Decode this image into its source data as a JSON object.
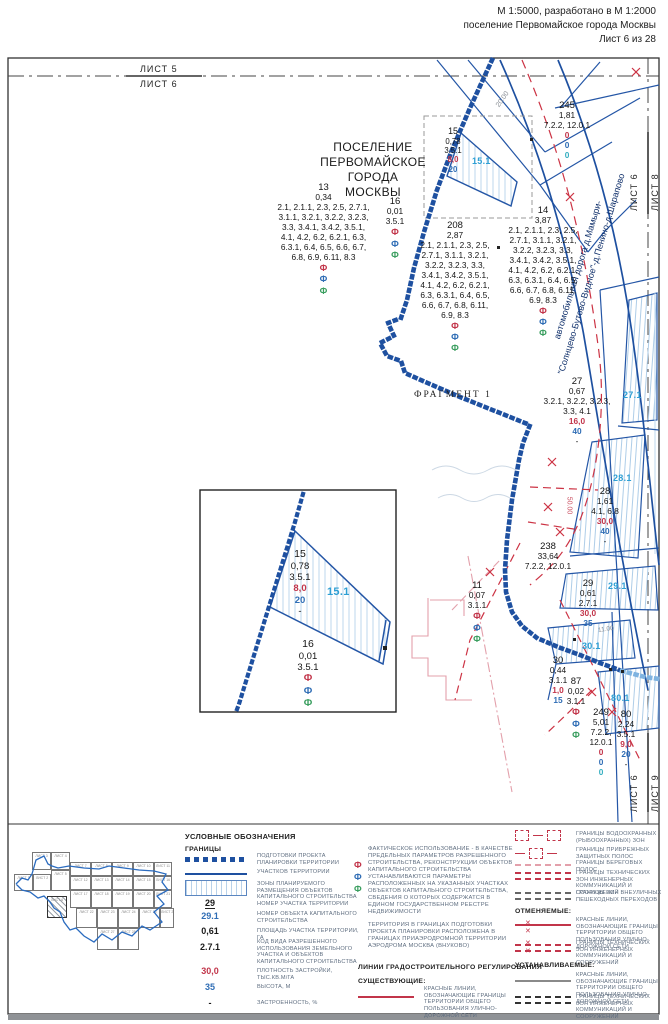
{
  "header": {
    "line1": "М 1:5000, разработано в М 1:2000",
    "line2": "поселение Первомайское города Москвы",
    "line3": "Лист 6 из 28"
  },
  "edge_labels": {
    "top_a": "ЛИСТ 5",
    "top_b": "ЛИСТ 6",
    "right_top_a": "ЛИСТ 6",
    "right_top_b": "ЛИСТ 8",
    "right_bottom_a": "ЛИСТ 6",
    "right_bottom_b": "ЛИСТ 9"
  },
  "map": {
    "settlement_line1": "ПОСЕЛЕНИЕ",
    "settlement_line2": "ПЕРВОМАЙСКОЕ",
    "settlement_line3": "ГОРОДА МОСКВЫ",
    "fragment_label": "ФРАГМЕНТ 1",
    "road_line1": "автомобильная дорога д.Мамыри-",
    "road_line2": "\"Солнцево-Бутово-Видное\"-д.Пенино-д.Шарапово",
    "dims": {
      "d20": "20.00",
      "d50": "50.00",
      "d11": "11.00"
    },
    "glyph_fact": "Ф",
    "parcels": {
      "p13": {
        "num": "13",
        "area": "0,34",
        "codes": "2.1, 2.1.1, 2.3, 2.5, 2.7.1, 3.1.1, 3.2.1, 3.2.2, 3.2.3, 3.3, 3.4.1, 3.4.2, 3.5.1, 4.1, 4.2, 6.2, 6.2.1, 6.3, 6.3.1, 6.4, 6.5, 6.6, 6.7, 6.8, 6.9, 6.11, 8.3"
      },
      "p16": {
        "num": "16",
        "area": "0,01",
        "codes": "3.5.1"
      },
      "p15": {
        "num": "15",
        "area": "0,78",
        "codes": "3.5.1",
        "density": "8,0",
        "height": "20",
        "built": "-"
      },
      "p245": {
        "num": "245",
        "area": "1,81",
        "codes": "7.2.2, 12.0.1",
        "density": "0",
        "height": "0",
        "built": "0"
      },
      "p208": {
        "num": "208",
        "area": "2,87",
        "codes": "2.1, 2.1.1, 2.3, 2.5, 2.7.1, 3.1.1, 3.2.1, 3.2.2, 3.2.3, 3.3, 3.4.1, 3.4.2, 3.5.1, 4.1, 4.2, 6.2, 6.2.1, 6.3, 6.3.1, 6.4, 6.5, 6.6, 6.7, 6.8, 6.11, 6.9, 8.3"
      },
      "p14": {
        "num": "14",
        "area": "3,87",
        "codes": "2.1, 2.1.1, 2.3, 2.5, 2.7.1, 3.1.1, 3.2.1, 3.2.2, 3.2.3, 3.3, 3.4.1, 3.4.2, 3.5.1, 4.1, 4.2, 6.2, 6.2.1, 6.3, 6.3.1, 6.4, 6.5, 6.6, 6.7, 6.8, 6.11, 6.9, 8.3"
      },
      "p27": {
        "num": "27",
        "area": "0,67",
        "codes": "3.2.1, 3.2.2, 3.2.3, 3.3, 4.1",
        "density": "16,0",
        "height": "40",
        "built": "-"
      },
      "p28": {
        "num": "28",
        "area": "1,61",
        "codes": "4.1, 6.8",
        "density": "30,0",
        "height": "40",
        "built": "-"
      },
      "p238": {
        "num": "238",
        "area": "33,64",
        "codes": "7.2.2, 12.0.1"
      },
      "p11": {
        "num": "11",
        "area": "0,07",
        "codes": "3.1.1"
      },
      "p29": {
        "num": "29",
        "area": "0,61",
        "codes": "2.7.1",
        "density": "30,0",
        "height": "35",
        "built": "-"
      },
      "p30": {
        "num": "30",
        "area": "0,44",
        "codes": "3.1.1",
        "density": "1,0",
        "height": "15",
        "built": "-"
      },
      "p87": {
        "num": "87",
        "area": "0,02",
        "codes": "3.1.1"
      },
      "p249": {
        "num": "249",
        "area": "5,01",
        "codes": "7.2.2, 12.0.1",
        "density": "0",
        "height": "0",
        "built": "0"
      },
      "p80": {
        "num": "80",
        "area": "2,24",
        "codes": "3.5.1",
        "density": "9,0",
        "height": "20",
        "built": "-"
      }
    },
    "zones": {
      "z15": "15.1",
      "z27": "27.1",
      "z28": "28.1",
      "z29": "29.1",
      "z30": "30.1",
      "z80": "80.1"
    }
  },
  "legend": {
    "title": "УСЛОВНЫЕ ОБОЗНАЧЕНИЯ",
    "granitsy": "ГРАНИЦЫ",
    "b_dotted": "ПОДГОТОВКИ ПРОЕКТА ПЛАНИРОВКИ ТЕРРИТОРИИ",
    "b_solid": "УЧАСТКОВ ТЕРРИТОРИИ",
    "b_hatch": "ЗОНЫ ПЛАНИРУЕМОГО РАЗМЕЩЕНИЯ ОБЪЕКТОВ КАПИТАЛЬНОГО СТРОИТЕЛЬСТВА",
    "n29": "29",
    "n29_l": "НОМЕР УЧАСТКА ТЕРРИТОРИИ",
    "n291": "29.1",
    "n291_l": "НОМЕР ОБЪЕКТА КАПИТАЛЬНОГО СТРОИТЕЛЬСТВА",
    "a061": "0,61",
    "a061_l": "ПЛОЩАДЬ УЧАСТКА ТЕРРИТОРИИ, ГА",
    "c271": "2.7.1",
    "c271_l": "КОД ВИДА РАЗРЕШЕННОГО ИСПОЛЬЗОВАНИЯ ЗЕМЕЛЬНОГО УЧАСТКА И ОБЪЕКТОВ КАПИТАЛЬНОГО СТРОИТЕЛЬСТВА",
    "d300": "30,0",
    "d300_l": "ПЛОТНОСТЬ ЗАСТРОЙКИ, ТЫС.КВ.М/ГА",
    "h35": "35",
    "h35_l": "ВЫСОТА, М",
    "dash": "-",
    "dash_l": "ЗАСТРОЕННОСТЬ, %",
    "fact_text": "ФАКТИЧЕСКОЕ ИСПОЛЬЗОВАНИЕ - В КАЧЕСТВЕ ПРЕДЕЛЬНЫХ ПАРАМЕТРОВ РАЗРЕШЕННОГО СТРОИТЕЛЬСТВА, РЕКОНСТРУКЦИИ ОБЪЕКТОВ КАПИТАЛЬНОГО СТРОИТЕЛЬСТВА УСТАНАВЛИВАЮТСЯ ПАРАМЕТРЫ РАСПОЛОЖЕННЫХ НА УКАЗАННЫХ УЧАСТКАХ ОБЪЕКТОВ КАПИТАЛЬНОГО СТРОИТЕЛЬСТВА, СВЕДЕНИЯ О КОТОРЫХ СОДЕРЖАТСЯ В ЕДИНОМ ГОСУДАРСТВЕННОМ РЕЕСТРЕ НЕДВИЖИМОСТИ",
    "terr_text": "ТЕРРИТОРИЯ В ГРАНИЦАХ ПОДГОТОВКИ ПРОЕКТА ПЛАНИРОВКИ РАСПОЛОЖЕНА В ГРАНИЦАХ ПРИАЭРОДРОМНОЙ ТЕРРИТОРИИ АЭРОДРОМА МОСКВА (ВНУКОВО)",
    "lines_head": "ЛИНИИ ГРАДОСТРОИТЕЛЬНОГО РЕГУЛИРОВАНИЯ",
    "exist_head": "СУЩЕСТВУЮЩИЕ:",
    "red_lines_l": "КРАСНЫЕ ЛИНИИ, ОБОЗНАЧАЮЩИЕ ГРАНИЦЫ ТЕРРИТОРИИ ОБЩЕГО ПОЛЬЗОВАНИЯ УЛИЧНО-ДОРОЖНОЙ СЕТИ",
    "water_l": "ГРАНИЦЫ ВОДООХРАННЫХ (РЫБООХРАННЫХ) ЗОН",
    "coastp_l": "ГРАНИЦЫ ПРИБРЕЖНЫХ ЗАЩИТНЫХ ПОЛОС",
    "coast_l": "ГРАНИЦЫ БЕРЕГОВЫХ ПОЛОС",
    "tech_l": "ГРАНИЦЫ ТЕХНИЧЕСКИХ ЗОН ИНЖЕНЕРНЫХ КОММУНИКАЦИЙ И СООРУЖЕНИЙ",
    "ped_l": "ГРАНИЦЫ ЗОН ВНЕУЛИЧНЫХ ПЕШЕХОДНЫХ ПЕРЕХОДОВ",
    "cancel_head": "ОТМЕНЯЕМЫЕ:",
    "set_head": "УСТАНАВЛИВАЕМЫЕ:",
    "minimap": {
      "sheets": [
        {
          "l": "ЛИСТ 3",
          "x": 18,
          "y": 8,
          "w": 19,
          "h": 18
        },
        {
          "l": "ЛИСТ 4",
          "x": 37,
          "y": 8,
          "w": 19,
          "h": 18
        },
        {
          "l": "ЛИСТ 1",
          "x": 0,
          "y": 30,
          "w": 19,
          "h": 17
        },
        {
          "l": "ЛИСТ 2",
          "x": 19,
          "y": 30,
          "w": 18,
          "h": 17
        },
        {
          "l": "ЛИСТ 5",
          "x": 37,
          "y": 26,
          "w": 19,
          "h": 21
        },
        {
          "l": "ЛИСТ 6",
          "x": 33,
          "y": 52,
          "w": 20,
          "h": 22,
          "hatch": true
        },
        {
          "l": "ЛИСТ 7",
          "x": 56,
          "y": 18,
          "w": 21,
          "h": 14
        },
        {
          "l": "ЛИСТ 8",
          "x": 77,
          "y": 18,
          "w": 21,
          "h": 14
        },
        {
          "l": "ЛИСТ 9",
          "x": 98,
          "y": 18,
          "w": 21,
          "h": 14
        },
        {
          "l": "ЛИСТ 10",
          "x": 119,
          "y": 18,
          "w": 21,
          "h": 14
        },
        {
          "l": "ЛИСТ 11",
          "x": 140,
          "y": 18,
          "w": 18,
          "h": 14
        },
        {
          "l": "ЛИСТ 12",
          "x": 56,
          "y": 32,
          "w": 21,
          "h": 14
        },
        {
          "l": "ЛИСТ 13",
          "x": 77,
          "y": 32,
          "w": 21,
          "h": 14
        },
        {
          "l": "ЛИСТ 14",
          "x": 98,
          "y": 32,
          "w": 21,
          "h": 14
        },
        {
          "l": "ЛИСТ 15",
          "x": 119,
          "y": 32,
          "w": 21,
          "h": 14
        },
        {
          "l": "ЛИСТ 16",
          "x": 140,
          "y": 32,
          "w": 18,
          "h": 14
        },
        {
          "l": "ЛИСТ 17",
          "x": 56,
          "y": 46,
          "w": 21,
          "h": 18
        },
        {
          "l": "ЛИСТ 18",
          "x": 77,
          "y": 46,
          "w": 21,
          "h": 18
        },
        {
          "l": "ЛИСТ 19",
          "x": 98,
          "y": 46,
          "w": 21,
          "h": 18
        },
        {
          "l": "ЛИСТ 20",
          "x": 119,
          "y": 46,
          "w": 21,
          "h": 18
        },
        {
          "l": "ЛИСТ 21",
          "x": 140,
          "y": 46,
          "w": 18,
          "h": 18
        },
        {
          "l": "ЛИСТ 22",
          "x": 62,
          "y": 64,
          "w": 21,
          "h": 20
        },
        {
          "l": "ЛИСТ 23",
          "x": 83,
          "y": 64,
          "w": 21,
          "h": 20
        },
        {
          "l": "ЛИСТ 24",
          "x": 104,
          "y": 64,
          "w": 21,
          "h": 20
        },
        {
          "l": "ЛИСТ 25",
          "x": 125,
          "y": 64,
          "w": 21,
          "h": 20
        },
        {
          "l": "ЛИСТ 26",
          "x": 146,
          "y": 64,
          "w": 14,
          "h": 20
        },
        {
          "l": "ЛИСТ 27",
          "x": 83,
          "y": 84,
          "w": 21,
          "h": 22
        },
        {
          "l": "ЛИСТ 28",
          "x": 104,
          "y": 84,
          "w": 21,
          "h": 22
        }
      ]
    }
  }
}
